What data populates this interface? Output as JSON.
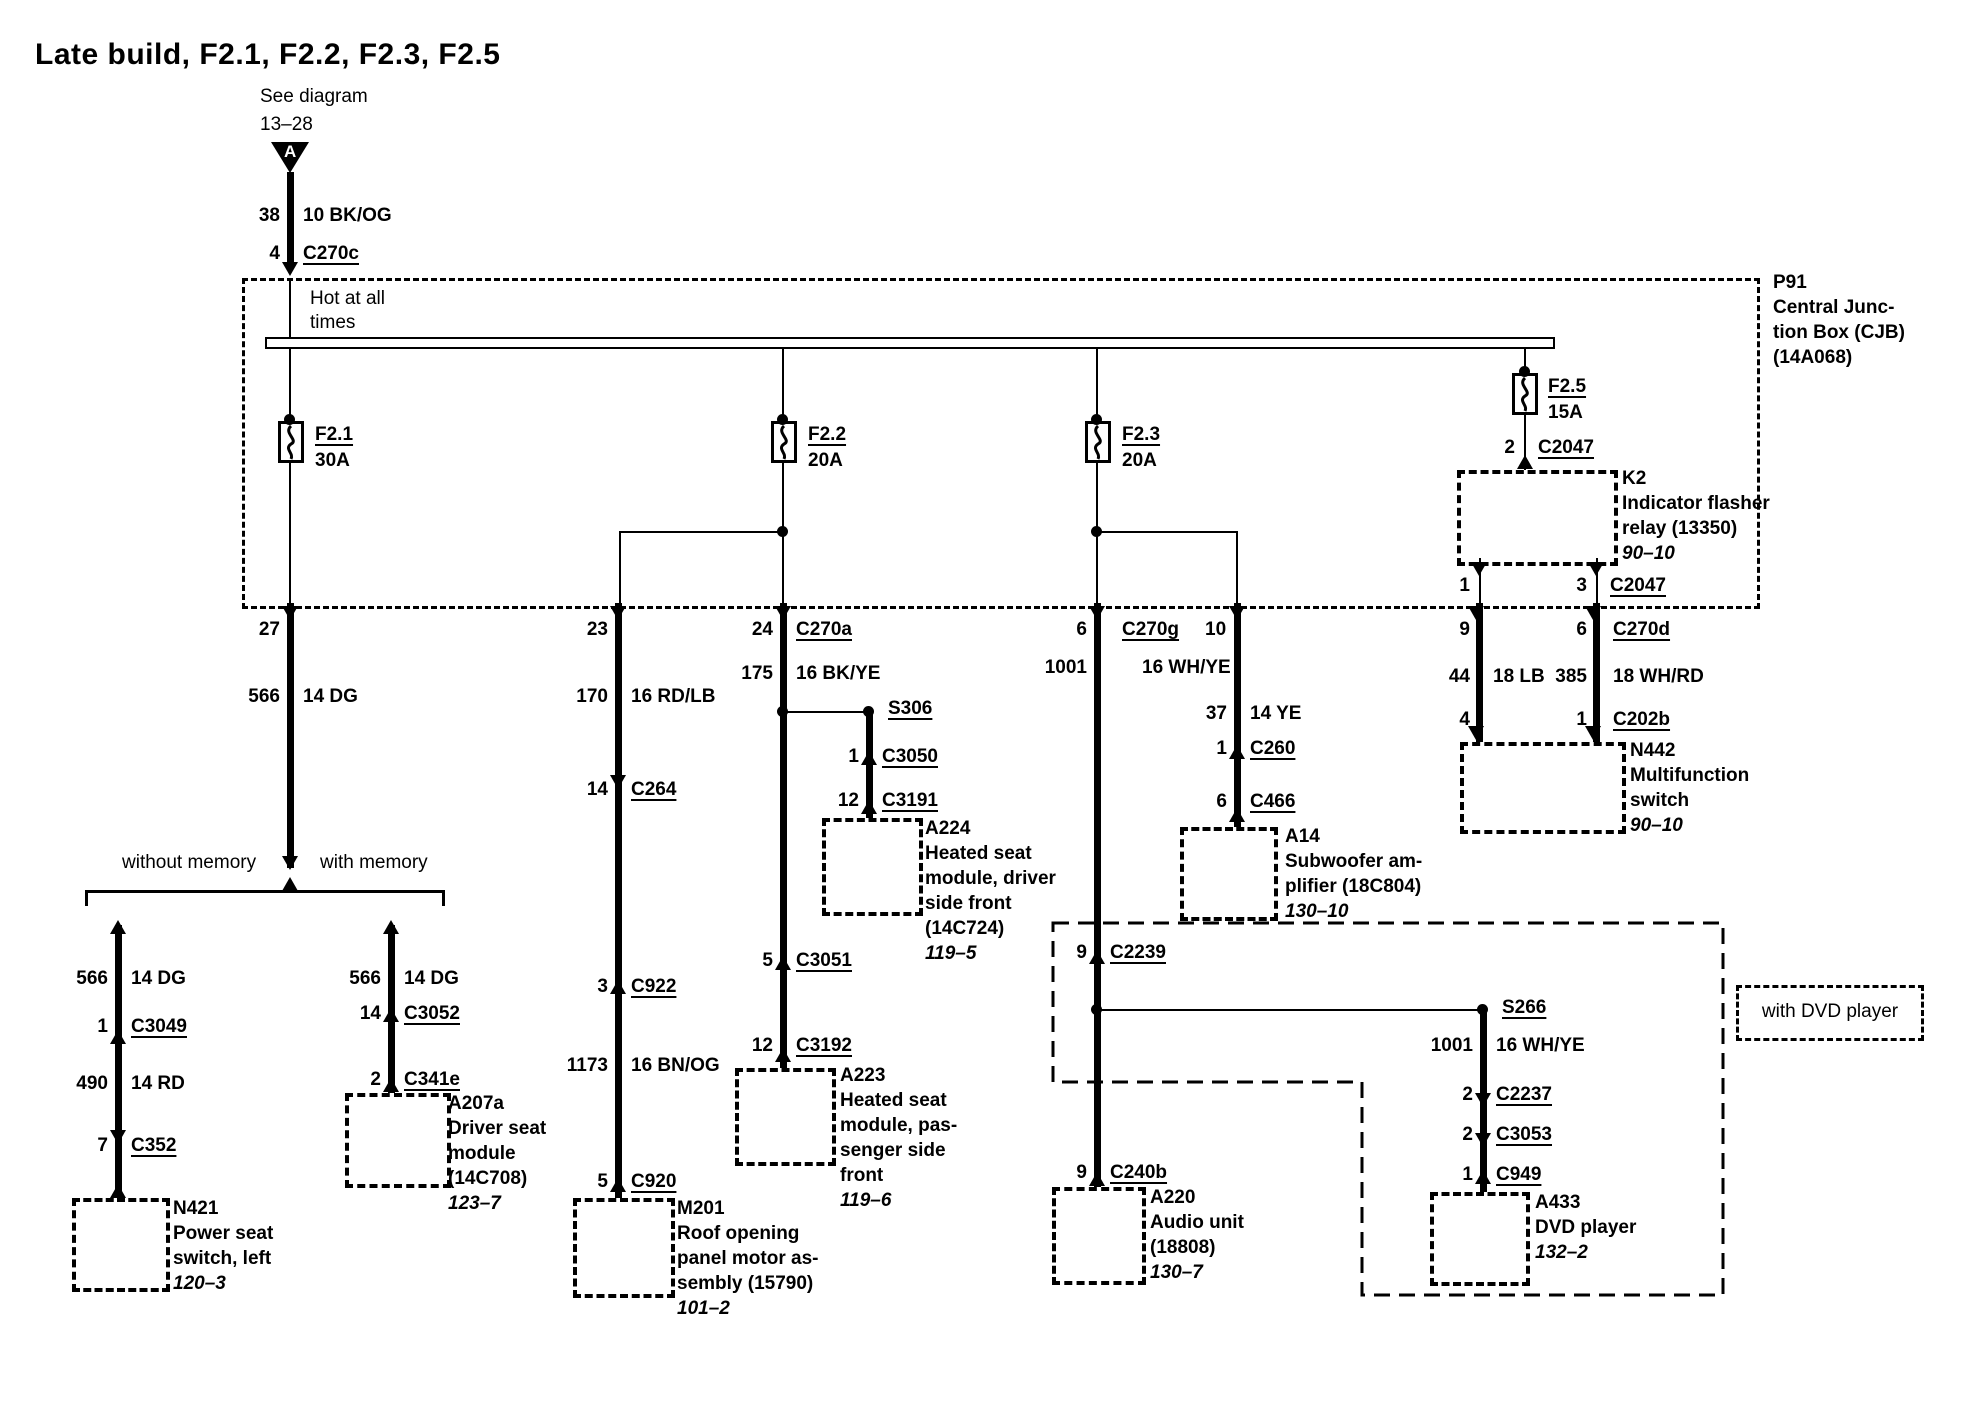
{
  "title": "Late build, F2.1, F2.2, F2.3, F2.5",
  "header": {
    "see_diagram_1": "See diagram",
    "see_diagram_2": "13–28",
    "marker_letter": "A"
  },
  "cjb": {
    "id": "P91",
    "name1": "Central Junc-",
    "name2": "tion Box (CJB)",
    "name3": "(14A068)",
    "hot1": "Hot at all",
    "hot2": "times"
  },
  "fuses": {
    "f21": {
      "id": "F2.1",
      "rating": "30A"
    },
    "f22": {
      "id": "F2.2",
      "rating": "20A"
    },
    "f23": {
      "id": "F2.3",
      "rating": "20A"
    },
    "f25": {
      "id": "F2.5",
      "rating": "15A"
    }
  },
  "branch": {
    "without_memory": "without memory",
    "with_memory": "with memory"
  },
  "with_dvd": "with DVD player",
  "rows": {
    "a1": {
      "l": "38",
      "r": "10 BK/OG"
    },
    "a2": {
      "l": "4",
      "r": "C270c"
    },
    "a3": {
      "l": "27"
    },
    "a4": {
      "l": "566",
      "r": "14 DG"
    },
    "a5": {
      "l": "566",
      "r": "14 DG"
    },
    "a6": {
      "l": "1",
      "r": "C3049"
    },
    "a7": {
      "l": "490",
      "r": "14 RD"
    },
    "a8": {
      "l": "7",
      "r": "C352"
    },
    "a9": {
      "l": "566",
      "r": "14 DG"
    },
    "a10": {
      "l": "14",
      "r": "C3052"
    },
    "a11": {
      "l": "2",
      "r": "C341e"
    },
    "b1": {
      "l": "23"
    },
    "b2": {
      "l": "170",
      "r": "16 RD/LB"
    },
    "b3": {
      "l": "14",
      "r": "C264"
    },
    "b4": {
      "l": "3",
      "r": "C922"
    },
    "b5": {
      "l": "1173",
      "r": "16 BN/OG"
    },
    "b6": {
      "l": "5",
      "r": "C920"
    },
    "c1": {
      "l": "24",
      "r": "C270a"
    },
    "c2": {
      "l": "175",
      "r": "16 BK/YE"
    },
    "c3": {
      "l": "5",
      "r": "C3051"
    },
    "c4": {
      "l": "12",
      "r": "C3192"
    },
    "s1": {
      "r": "S306"
    },
    "s2": {
      "l": "1",
      "r": "C3050"
    },
    "s3": {
      "l": "12",
      "r": "C3191"
    },
    "d1": {
      "l": "6",
      "m": "C270g",
      "r": "10"
    },
    "d2": {
      "l": "1001",
      "r": "16 WH/YE"
    },
    "d3": {
      "l": "9",
      "r": "C2239"
    },
    "d4": {
      "l": "9",
      "r": "C240b"
    },
    "e1": {
      "l": "37",
      "r": "14 YE"
    },
    "e2": {
      "l": "1",
      "r": "C260"
    },
    "e3": {
      "l": "6",
      "r": "C466"
    },
    "f1": {
      "l": "2",
      "r": "C2047"
    },
    "g1": {
      "l": "1"
    },
    "g2": {
      "l": "3",
      "r": "C2047"
    },
    "h1": {
      "l": "9"
    },
    "h2": {
      "l": "44",
      "r": "18 LB"
    },
    "h3": {
      "l": "4"
    },
    "h4": {
      "l": "6",
      "r": "C270d"
    },
    "h5": {
      "l": "385",
      "r": "18 WH/RD"
    },
    "h6": {
      "l": "1",
      "r": "C202b"
    },
    "s4": {
      "r": "S266"
    },
    "d5": {
      "l": "1001",
      "r": "16 WH/YE"
    },
    "d6": {
      "l": "2",
      "r": "C2237"
    },
    "d7": {
      "l": "2",
      "r": "C3053"
    },
    "d8": {
      "l": "1",
      "r": "C949"
    }
  },
  "components": {
    "k2": {
      "id": "K2",
      "lines": [
        "Indicator flasher",
        "relay (13350)"
      ],
      "page": "90–10"
    },
    "n442": {
      "id": "N442",
      "lines": [
        "Multifunction",
        "switch"
      ],
      "page": "90–10"
    },
    "n421": {
      "id": "N421",
      "lines": [
        "Power seat",
        "switch, left"
      ],
      "page": "120–3"
    },
    "a207a": {
      "id": "A207a",
      "lines": [
        "Driver seat",
        "module",
        "(14C708)"
      ],
      "page": "123–7"
    },
    "m201": {
      "id": "M201",
      "lines": [
        "Roof opening",
        "panel motor as-",
        "sembly (15790)"
      ],
      "page": "101–2"
    },
    "a224": {
      "id": "A224",
      "lines": [
        "Heated seat",
        "module, driver",
        "side front",
        "(14C724)"
      ],
      "page": "119–5"
    },
    "a223": {
      "id": "A223",
      "lines": [
        "Heated seat",
        "module, pas-",
        "senger side",
        "front"
      ],
      "page": "119–6"
    },
    "a14": {
      "id": "A14",
      "lines": [
        "Subwoofer am-",
        "plifier (18C804)"
      ],
      "page": "130–10"
    },
    "a220": {
      "id": "A220",
      "lines": [
        "Audio unit",
        "(18808)"
      ],
      "page": "130–7"
    },
    "a433": {
      "id": "A433",
      "lines": [
        "DVD player"
      ],
      "page": "132–2"
    }
  }
}
